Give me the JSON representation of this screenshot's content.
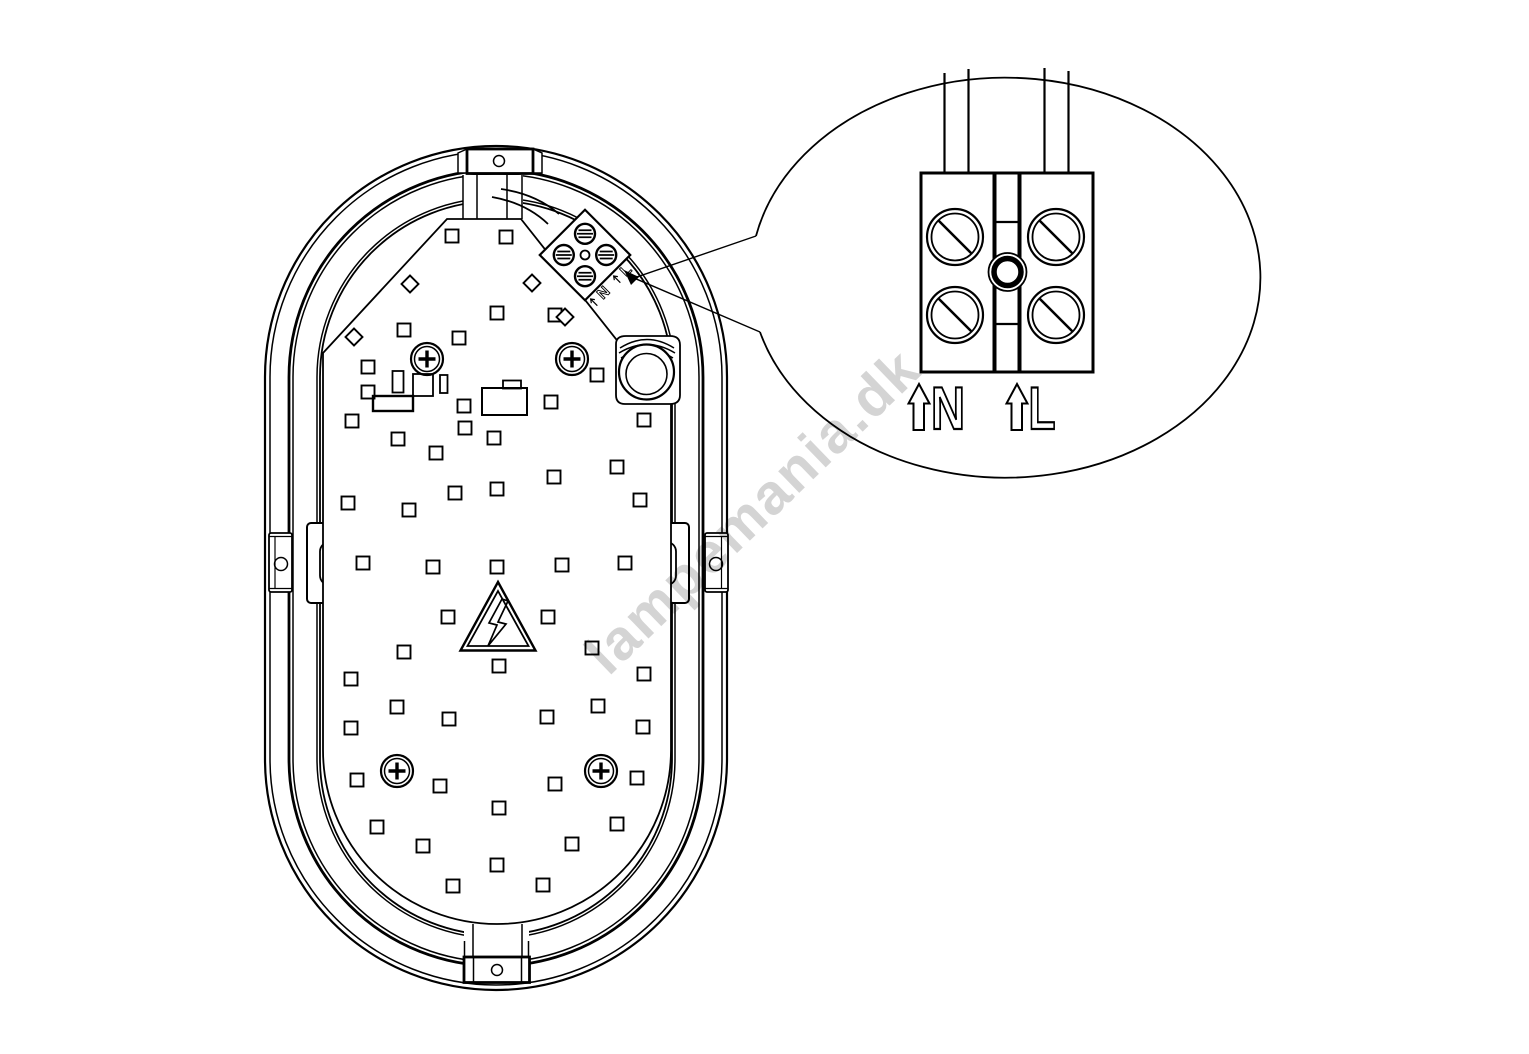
{
  "drawing": {
    "kind": "technical-line-drawing",
    "subject": "oval-bulkhead-luminaire-rear-view-with-terminal-detail"
  },
  "colors": {
    "line": "#000000",
    "background": "#ffffff",
    "watermark": "#c9c9c9"
  },
  "watermark": {
    "text": "lampemania.dk"
  },
  "main_view": {
    "terminal_block": {
      "labels": [
        "N",
        "L"
      ],
      "screw_offsets": [
        [
          -15,
          -15
        ],
        [
          15,
          -15
        ],
        [
          -15,
          15
        ],
        [
          15,
          15
        ]
      ]
    },
    "phillips_screws": [
      [
        427,
        359
      ],
      [
        572,
        359
      ],
      [
        397,
        771
      ],
      [
        601,
        771
      ]
    ],
    "diamond_pads": [
      [
        354,
        337
      ],
      [
        410,
        284
      ],
      [
        532,
        283
      ],
      [
        565,
        317
      ]
    ],
    "led_pads": [
      [
        452,
        236
      ],
      [
        506,
        237
      ],
      [
        404,
        330
      ],
      [
        459,
        338
      ],
      [
        497,
        313
      ],
      [
        555,
        315
      ],
      [
        368,
        367
      ],
      [
        368,
        392
      ],
      [
        352,
        421
      ],
      [
        398,
        439
      ],
      [
        464,
        406
      ],
      [
        465,
        428
      ],
      [
        494,
        438
      ],
      [
        551,
        402
      ],
      [
        597,
        375
      ],
      [
        644,
        420
      ],
      [
        617,
        467
      ],
      [
        640,
        500
      ],
      [
        436,
        453
      ],
      [
        455,
        493
      ],
      [
        497,
        489
      ],
      [
        554,
        477
      ],
      [
        348,
        503
      ],
      [
        409,
        510
      ],
      [
        363,
        563
      ],
      [
        433,
        567
      ],
      [
        497,
        567
      ],
      [
        562,
        565
      ],
      [
        625,
        563
      ],
      [
        448,
        617
      ],
      [
        548,
        617
      ],
      [
        404,
        652
      ],
      [
        499,
        666
      ],
      [
        592,
        648
      ],
      [
        644,
        674
      ],
      [
        351,
        679
      ],
      [
        397,
        707
      ],
      [
        449,
        719
      ],
      [
        547,
        717
      ],
      [
        598,
        706
      ],
      [
        351,
        728
      ],
      [
        643,
        727
      ],
      [
        357,
        780
      ],
      [
        440,
        786
      ],
      [
        555,
        784
      ],
      [
        637,
        778
      ],
      [
        377,
        827
      ],
      [
        499,
        808
      ],
      [
        617,
        824
      ],
      [
        423,
        846
      ],
      [
        572,
        844
      ],
      [
        497,
        865
      ],
      [
        453,
        886
      ],
      [
        543,
        885
      ]
    ]
  },
  "detail_view": {
    "labels": [
      {
        "letter": "N"
      },
      {
        "letter": "L"
      }
    ],
    "screw_positions": [
      [
        955,
        237
      ],
      [
        1056,
        237
      ],
      [
        955,
        315
      ],
      [
        1056,
        315
      ]
    ]
  }
}
